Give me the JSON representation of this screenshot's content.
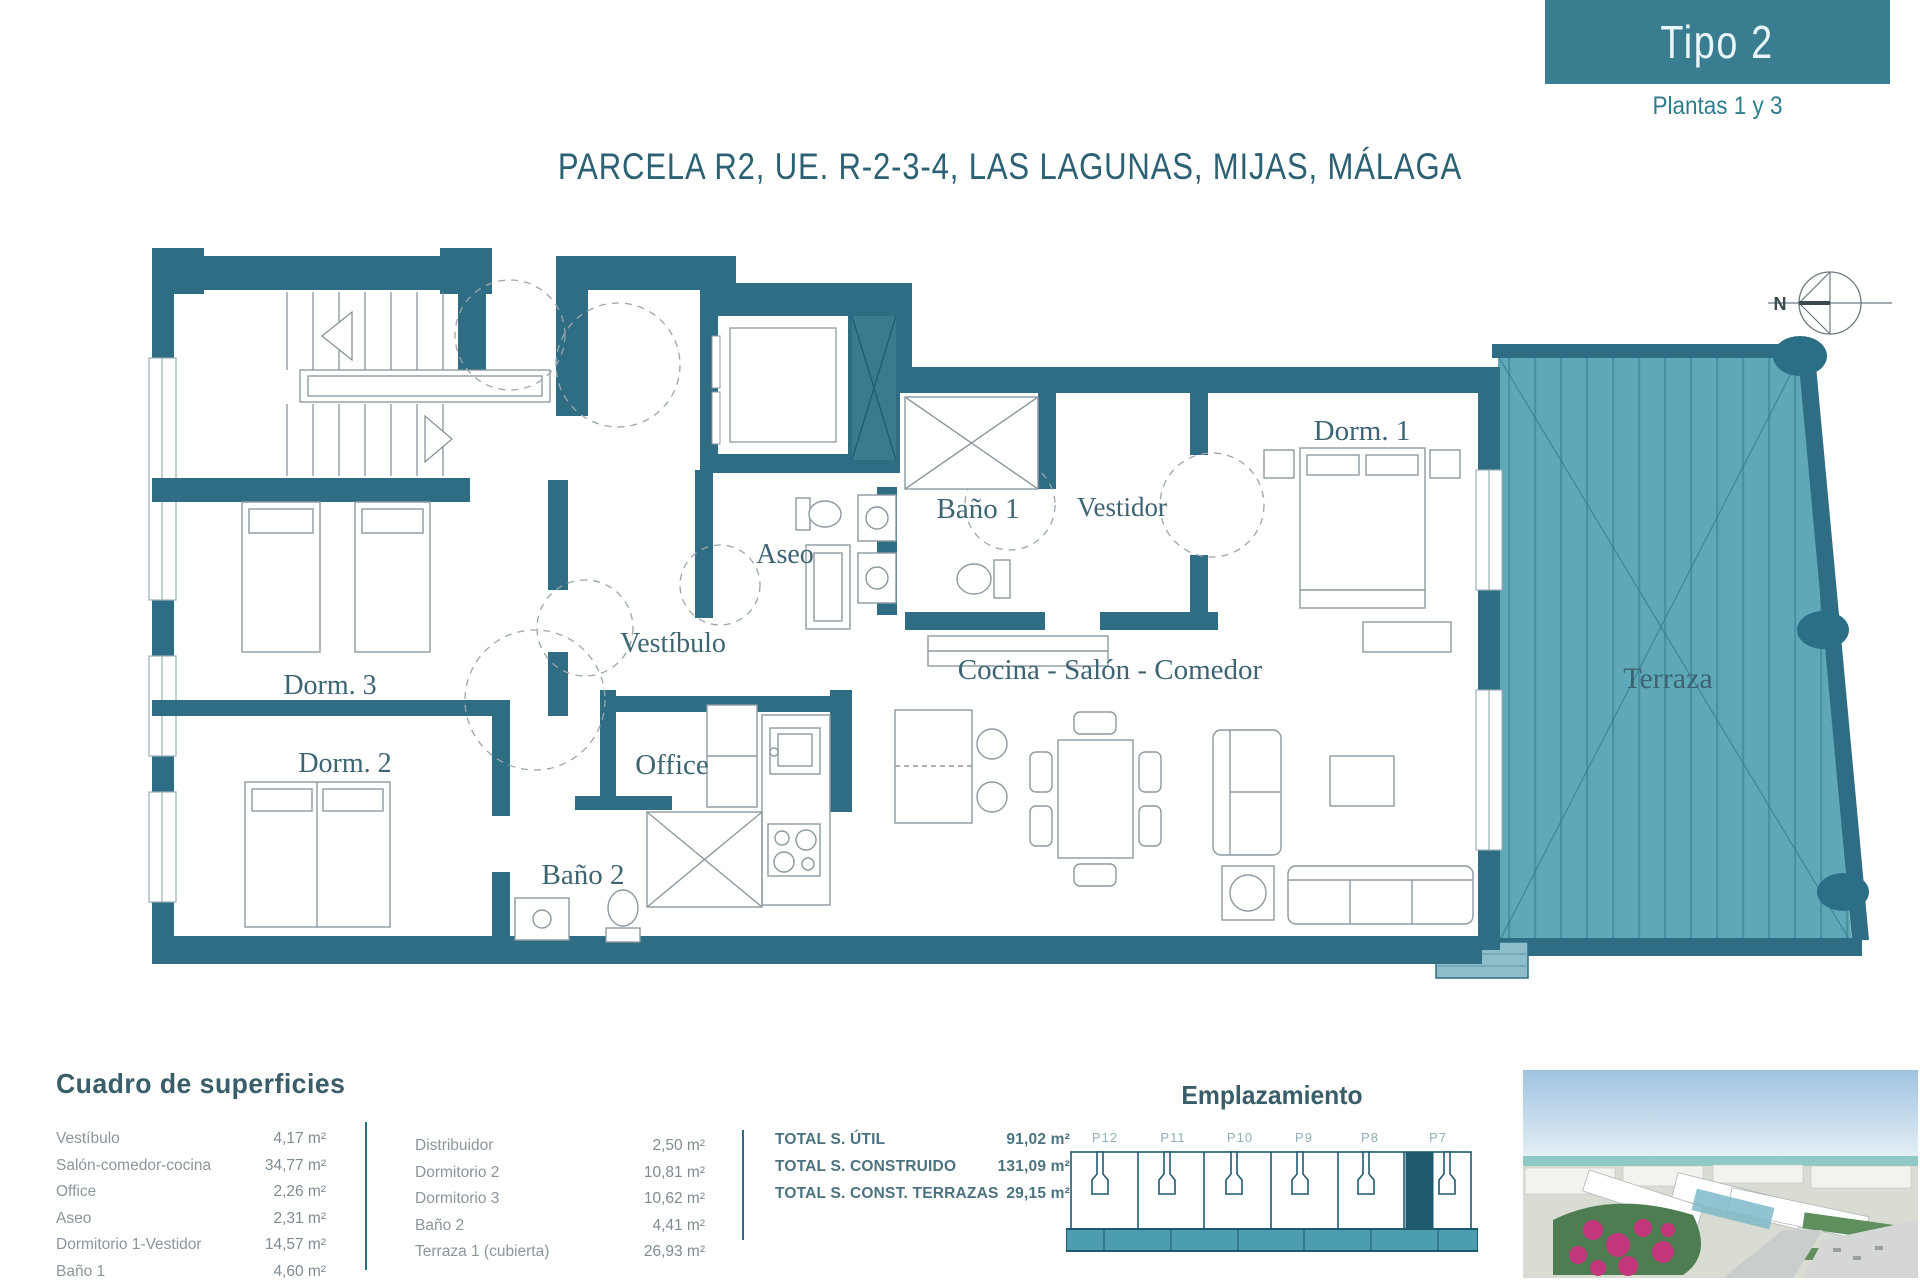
{
  "header": {
    "type_label": "Tipo 2",
    "floors_label": "Plantas 1 y 3"
  },
  "title": "PARCELA R2, UE. R-2-3-4, LAS LAGUNAS, MIJAS, MÁLAGA",
  "compass": {
    "north_label": "N"
  },
  "plan": {
    "rooms": {
      "dorm1": "Dorm. 1",
      "dorm2": "Dorm. 2",
      "dorm3": "Dorm. 3",
      "vestibulo": "Vestíbulo",
      "aseo": "Aseo",
      "bano1": "Baño 1",
      "vestidor": "Vestidor",
      "office": "Office",
      "bano2": "Baño 2",
      "living": "Cocina - Salón - Comedor",
      "terraza": "Terraza"
    },
    "colors": {
      "wall": "#2F6D85",
      "terrace_fill": "#5FA8B8",
      "accent_dark": "#1E5A6F"
    }
  },
  "surfaces": {
    "heading": "Cuadro de superficies",
    "column1": [
      {
        "label": "Vestíbulo",
        "value": "4,17 m²"
      },
      {
        "label": "Salón-comedor-cocina",
        "value": "34,77 m²"
      },
      {
        "label": "Office",
        "value": "2,26 m²"
      },
      {
        "label": "Aseo",
        "value": "2,31 m²"
      },
      {
        "label": "Dormitorio 1-Vestidor",
        "value": "14,57 m²"
      },
      {
        "label": "Baño 1",
        "value": "4,60 m²"
      }
    ],
    "column2": [
      {
        "label": "Distribuidor",
        "value": "2,50 m²"
      },
      {
        "label": "Dormitorio 2",
        "value": "10,81 m²"
      },
      {
        "label": "Dormitorio 3",
        "value": "10,62 m²"
      },
      {
        "label": "Baño 2",
        "value": "4,41 m²"
      },
      {
        "label": "Terraza 1 (cubierta)",
        "value": "26,93 m²"
      }
    ],
    "totals": [
      {
        "label": "TOTAL S. ÚTIL",
        "value": "91,02 m²"
      },
      {
        "label": "TOTAL S. CONSTRUIDO",
        "value": "131,09 m²"
      },
      {
        "label": "TOTAL S. CONST. TERRAZAS",
        "value": "29,15 m²"
      }
    ]
  },
  "emplazamiento": {
    "heading": "Emplazamiento",
    "units": [
      "P12",
      "P11",
      "P10",
      "P9",
      "P8",
      "P7"
    ],
    "highlighted_unit": "P7"
  }
}
